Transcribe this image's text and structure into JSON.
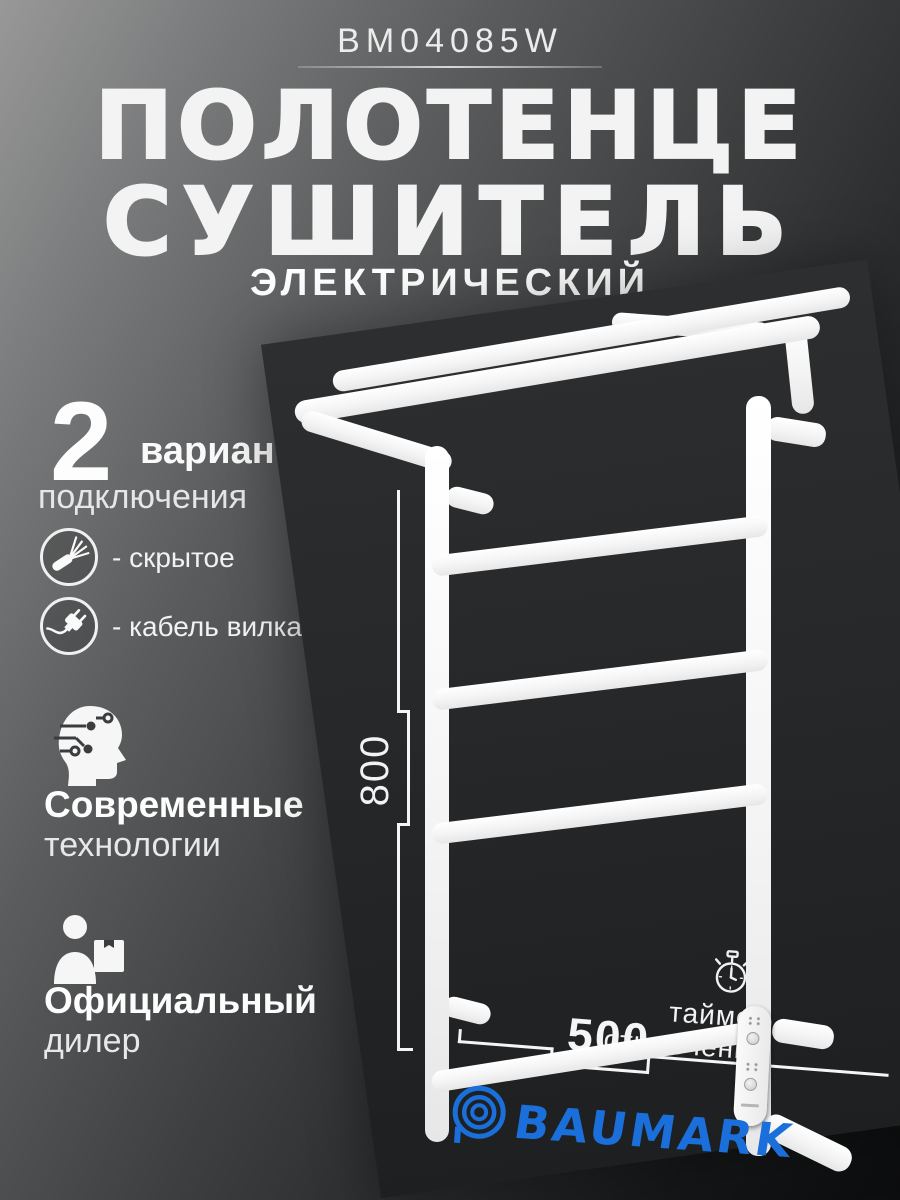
{
  "header": {
    "model": "BM04085W",
    "title_line1": "ПОЛОТЕНЦЕ",
    "title_line2": "СУШИТЕЛЬ",
    "subtitle": "ЭЛЕКТРИЧЕСКИЙ"
  },
  "features": {
    "variants": {
      "number": "2",
      "label": "варианта",
      "sublabel": "подключения",
      "options": [
        {
          "icon": "cable-icon",
          "label": "- скрытое"
        },
        {
          "icon": "plug-icon",
          "label": "- кабель вилка"
        }
      ]
    },
    "tech": {
      "icon": "ai-head-icon",
      "line1": "Современные",
      "line2": "технологии"
    },
    "dealer": {
      "icon": "dealer-box-icon",
      "line1": "Официальный",
      "line2": "дилер"
    }
  },
  "product": {
    "height_label": "800",
    "width_label": "500",
    "timer": {
      "icon": "stopwatch-icon",
      "line1": "таймер",
      "line2": "отключения"
    }
  },
  "brand": {
    "icon": "baumark-rings-icon",
    "name": "BAUMARK",
    "accent_color": "#1a6fdb"
  },
  "colors": {
    "accent_blue": "#1a6fdb",
    "backdrop_panel": "#26282a",
    "rail_white": "#f5f5f5"
  }
}
